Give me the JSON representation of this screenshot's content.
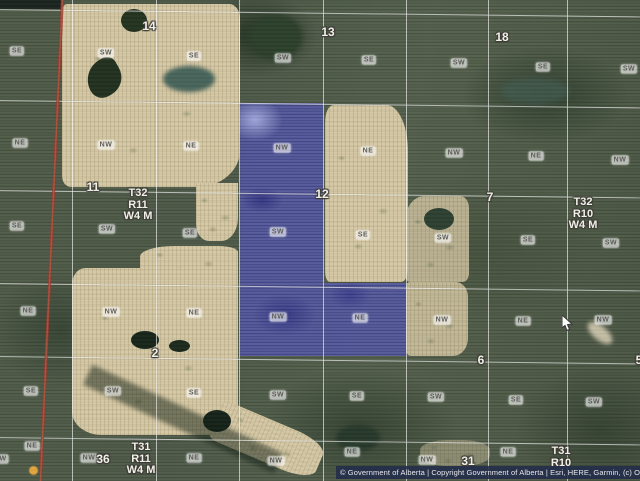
{
  "map": {
    "attribution_text": "© Government of Alberta | Copyright Government of Alberta | Esri, HERE, Garmin, (c) Ope",
    "township_labels": [
      {
        "lines": "T32\nR11\nW4 M",
        "x": 138,
        "y": 188
      },
      {
        "lines": "T32\nR10\nW4 M",
        "x": 583,
        "y": 197
      },
      {
        "lines": "T31\nR11\nW4 M",
        "x": 141,
        "y": 442
      },
      {
        "lines": "T31\nR10",
        "x": 561,
        "y": 446
      }
    ],
    "section_numbers": [
      {
        "n": "14",
        "x": 149,
        "y": 26
      },
      {
        "n": "13",
        "x": 328,
        "y": 32
      },
      {
        "n": "18",
        "x": 502,
        "y": 37
      },
      {
        "n": "11",
        "x": 93,
        "y": 187
      },
      {
        "n": "12",
        "x": 322,
        "y": 194
      },
      {
        "n": "7",
        "x": 490,
        "y": 197
      },
      {
        "n": "2",
        "x": 155,
        "y": 353
      },
      {
        "n": "6",
        "x": 481,
        "y": 360
      },
      {
        "n": "5",
        "x": 639,
        "y": 360
      },
      {
        "n": "36",
        "x": 103,
        "y": 459
      },
      {
        "n": "31",
        "x": 468,
        "y": 461
      }
    ],
    "quarter_labels": [
      {
        "t": "SE",
        "x": 17,
        "y": 51
      },
      {
        "t": "SW",
        "x": 106,
        "y": 53
      },
      {
        "t": "SE",
        "x": 194,
        "y": 56
      },
      {
        "t": "SW",
        "x": 283,
        "y": 58
      },
      {
        "t": "SE",
        "x": 369,
        "y": 60
      },
      {
        "t": "SW",
        "x": 459,
        "y": 63
      },
      {
        "t": "SE",
        "x": 543,
        "y": 67
      },
      {
        "t": "SW",
        "x": 629,
        "y": 69
      },
      {
        "t": "NE",
        "x": 20,
        "y": 143
      },
      {
        "t": "NW",
        "x": 106,
        "y": 145
      },
      {
        "t": "NE",
        "x": 191,
        "y": 146
      },
      {
        "t": "NW",
        "x": 282,
        "y": 148
      },
      {
        "t": "NE",
        "x": 368,
        "y": 151
      },
      {
        "t": "NW",
        "x": 454,
        "y": 153
      },
      {
        "t": "NE",
        "x": 536,
        "y": 156
      },
      {
        "t": "NW",
        "x": 620,
        "y": 160
      },
      {
        "t": "SE",
        "x": 17,
        "y": 226
      },
      {
        "t": "SW",
        "x": 107,
        "y": 229
      },
      {
        "t": "SE",
        "x": 190,
        "y": 233
      },
      {
        "t": "SW",
        "x": 278,
        "y": 232
      },
      {
        "t": "SE",
        "x": 363,
        "y": 235
      },
      {
        "t": "SW",
        "x": 443,
        "y": 238
      },
      {
        "t": "SE",
        "x": 528,
        "y": 240
      },
      {
        "t": "SW",
        "x": 611,
        "y": 243
      },
      {
        "t": "NE",
        "x": 28,
        "y": 311
      },
      {
        "t": "NW",
        "x": 111,
        "y": 312
      },
      {
        "t": "NE",
        "x": 194,
        "y": 313
      },
      {
        "t": "NW",
        "x": 278,
        "y": 317
      },
      {
        "t": "NE",
        "x": 360,
        "y": 318
      },
      {
        "t": "NW",
        "x": 442,
        "y": 320
      },
      {
        "t": "NE",
        "x": 523,
        "y": 321
      },
      {
        "t": "NW",
        "x": 603,
        "y": 320
      },
      {
        "t": "SE",
        "x": 31,
        "y": 391
      },
      {
        "t": "SW",
        "x": 113,
        "y": 391
      },
      {
        "t": "SE",
        "x": 194,
        "y": 393
      },
      {
        "t": "SW",
        "x": 278,
        "y": 395
      },
      {
        "t": "SE",
        "x": 357,
        "y": 396
      },
      {
        "t": "SW",
        "x": 436,
        "y": 397
      },
      {
        "t": "SE",
        "x": 516,
        "y": 400
      },
      {
        "t": "SW",
        "x": 594,
        "y": 402
      },
      {
        "t": "NE",
        "x": 32,
        "y": 446
      },
      {
        "t": "NW",
        "x": 89,
        "y": 458
      },
      {
        "t": "NE",
        "x": 194,
        "y": 458
      },
      {
        "t": "NW",
        "x": 276,
        "y": 461
      },
      {
        "t": "NE",
        "x": 352,
        "y": 452
      },
      {
        "t": "NW",
        "x": 427,
        "y": 460
      },
      {
        "t": "NE",
        "x": 508,
        "y": 452
      },
      {
        "t": "W",
        "x": 3,
        "y": 459
      }
    ],
    "grid": {
      "v_lines": [
        72,
        156,
        239,
        323,
        406,
        488,
        567
      ],
      "h_lines": [
        9,
        100,
        190,
        283,
        356,
        437
      ]
    },
    "highlight_polygon": [
      [
        239,
        103
      ],
      [
        323,
        103
      ],
      [
        323,
        283
      ],
      [
        406,
        283
      ],
      [
        406,
        356
      ],
      [
        239,
        356
      ]
    ],
    "colors": {
      "highlight_fill": "#4d4dc4",
      "grid_line": "#ffffff",
      "survey_line_red": "#a83a2c",
      "attribution_bar": "#222c4a",
      "farmland_tan": "#d3c5a0",
      "base_green": "#4a5645"
    }
  },
  "cursor": {
    "x": 562,
    "y": 315
  }
}
